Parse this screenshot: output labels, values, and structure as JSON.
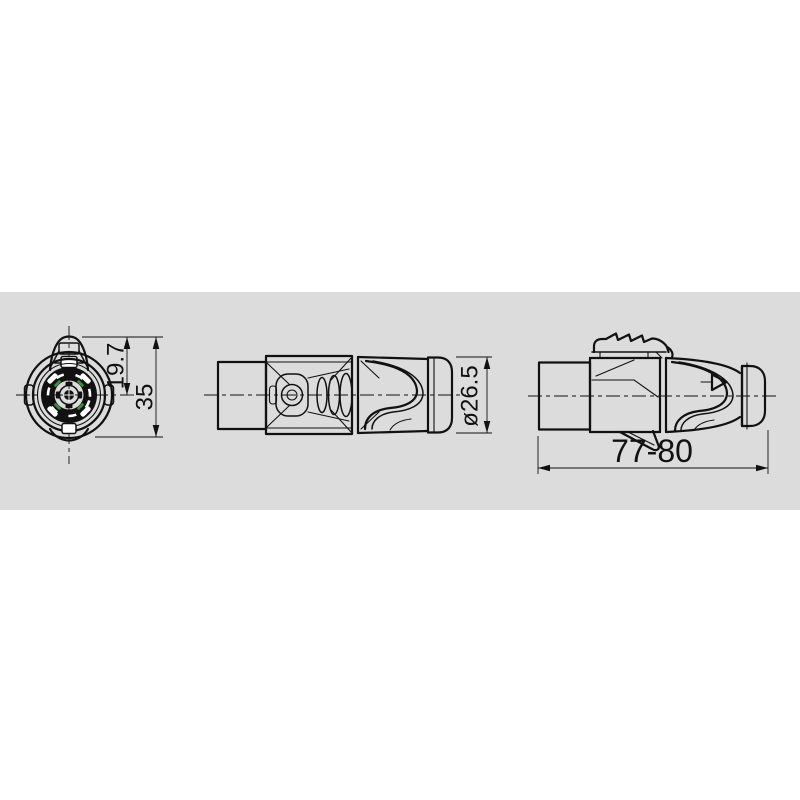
{
  "colors": {
    "background": "#ffffff",
    "band": "#dcdcdc",
    "line": "#111111",
    "contact_marks": "#3a8f3a"
  },
  "views": {
    "front": {
      "dim_inner": "19.7",
      "dim_overall": "35"
    },
    "side": {
      "dim_diameter": "ø26.5"
    },
    "assembly": {
      "dim_length": "77-80"
    }
  }
}
